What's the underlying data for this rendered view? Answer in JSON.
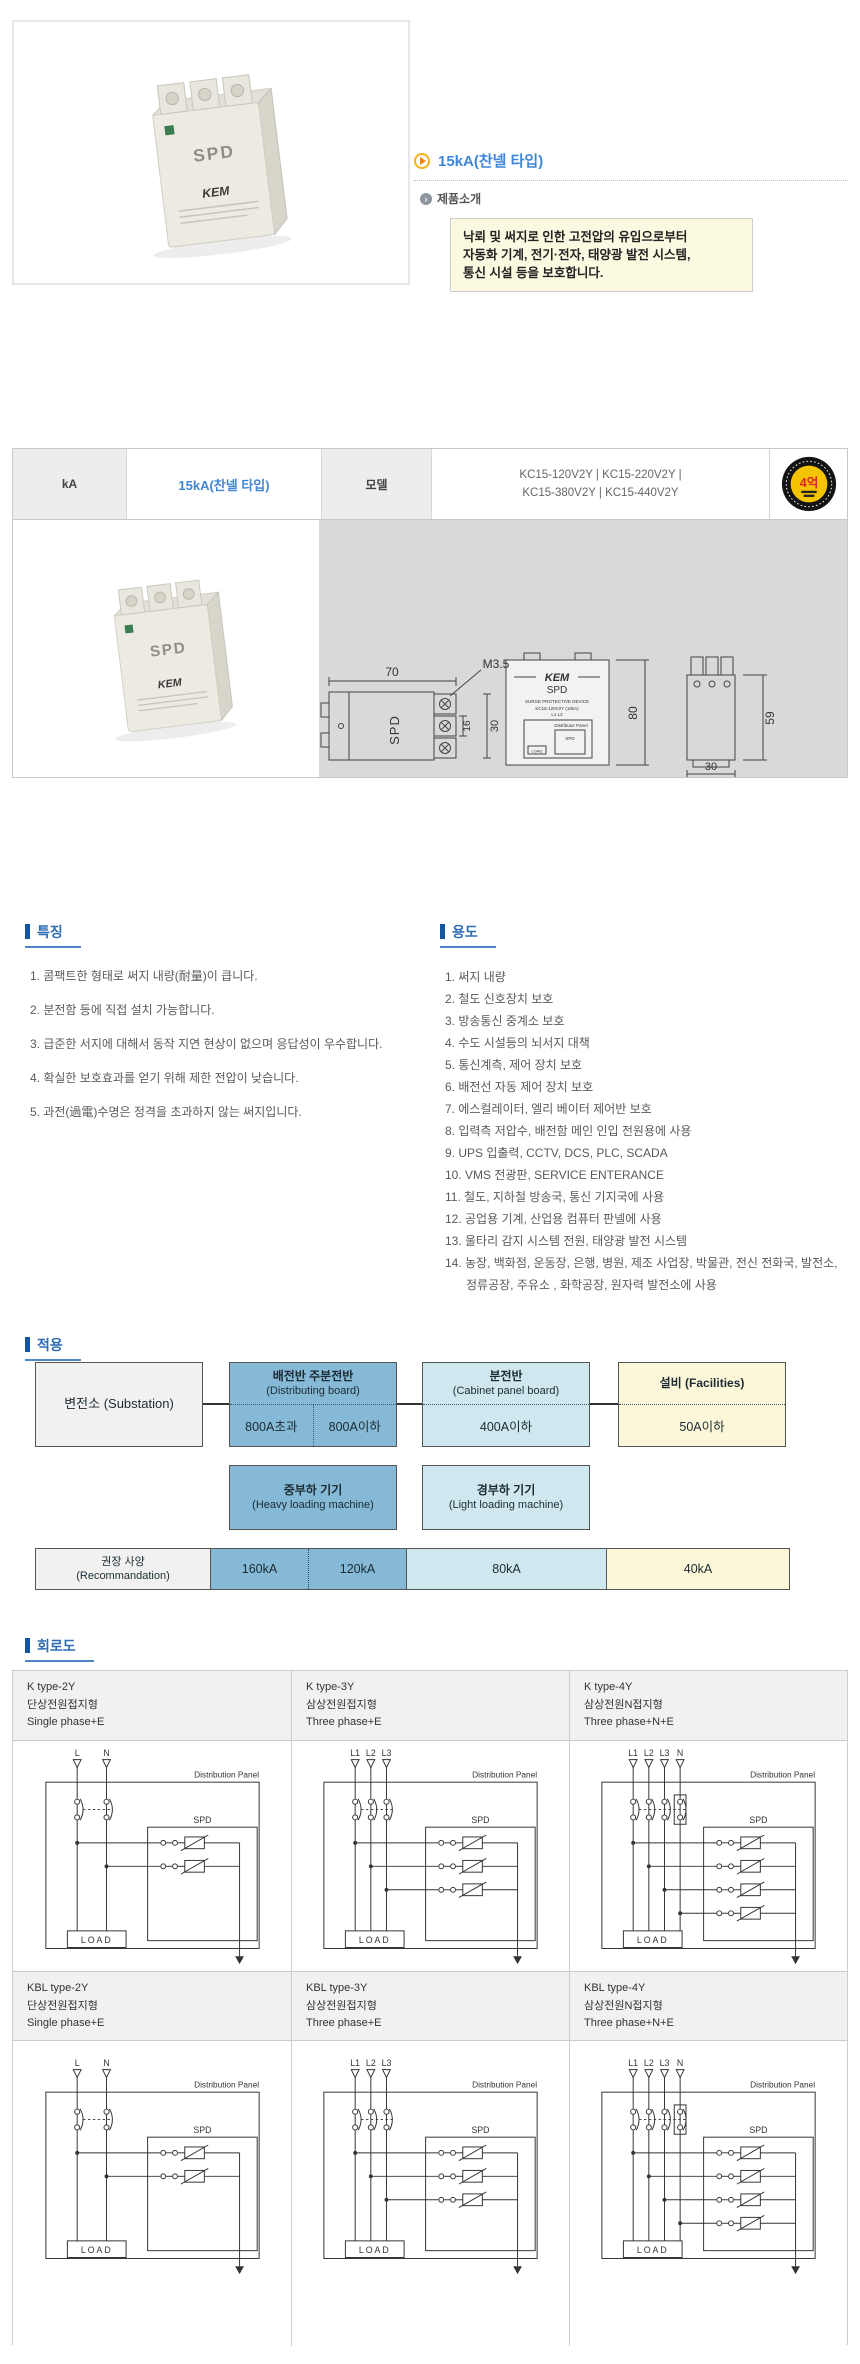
{
  "page": {
    "title": "15kA(찬넬 타입)",
    "intro_label": "제품소개",
    "intro_lines": [
      "낙뢰 및 써지로 인한 고전압의 유입으로부터",
      "자동화 기계, 전기·전자, 태양광 발전 시스템,",
      "통신 시설 등을 보호합니다."
    ]
  },
  "colors": {
    "title_blue": "#3f86d8",
    "section_blue": "#2e6db4",
    "intro_yellow": "#fcf9e1",
    "flow_blue": "#85b9d6",
    "flow_light_blue": "#cfe8ef",
    "flow_yellow": "#fbf7d8",
    "badge_red": "#e02424",
    "badge_yellow": "#f5c400"
  },
  "spec_table": {
    "kA_label": "kA",
    "kA_value": "15kA(찬넬 타입)",
    "model_label": "모델",
    "model_line1": "KC15-120V2Y | KC15-220V2Y |",
    "model_line2": "KC15-380V2Y | KC15-440V2Y",
    "badge_text": "4억"
  },
  "drawing": {
    "dims": {
      "w70": "70",
      "m35": "M3.5",
      "d16": "16",
      "d30": "30",
      "h80": "80",
      "h59": "59",
      "depth30": "30"
    },
    "device": {
      "brand": "KEM",
      "label": "SPD",
      "sub1": "SURGE PROTECTIVE DEVICE",
      "sub2": "KC15-120V2Y (15kA)",
      "sub3": "L1 L2",
      "mini_panel": "Distributor Panel",
      "mini_spd": "SPD",
      "mini_load": "LOAD"
    }
  },
  "features": {
    "title": "특징",
    "items": [
      "1. 콤팩트한 형태로 써지 내량(耐量)이 큽니다.",
      "2. 분전함 등에 직접 설치 가능합니다.",
      "3. 급준한 서지에 대해서 동작 지연 현상이 없으며 응답성이 우수합니다.",
      "4. 확실한 보호효과를 얻기 위해 제한 전압이 낮습니다.",
      "5. 과전(過電)수명은 정격을 초과하지 않는 써지입니다."
    ]
  },
  "uses": {
    "title": "용도",
    "items": [
      "1. 써지 내량",
      "2. 철도 신호장치 보호",
      "3. 방송통신 중계소 보호",
      "4. 수도 시설등의 뇌서지 대책",
      "5. 통신계측, 제어 장치 보호",
      "6. 배전선 자동 제어 장치 보호",
      "7. 에스컬레이터, 엘리 베이터 제어반 보호",
      "8. 입력측 저압수, 배전함 메인 인입 전원용에 사용",
      "9. UPS 입출력, CCTV, DCS, PLC, SCADA",
      "10. VMS 전광판, SERVICE ENTERANCE",
      "11. 철도, 지하철 방송국, 통신 기지국에 사용",
      "12. 공업용 기계, 산업용 컴퓨터 판넬에 사용",
      "13. 울타리 감지 시스템 전원, 태양광 발전 시스템",
      "14. 농장, 백화점, 운동장, 은행, 병원, 제조 사업장, 박물관, 전신 전화국, 발전소, 정류공장, 주유소 , 화학공장, 원자력 발전소에 사용"
    ]
  },
  "application": {
    "title": "적용",
    "substation": "변전소 (Substation)",
    "dist_title": "배전반 주분전반",
    "dist_sub": "(Distributing board)",
    "dist_left": "800A초과",
    "dist_right": "800A이하",
    "cabinet_title": "분전반",
    "cabinet_sub": "(Cabinet panel board)",
    "cabinet_val": "400A이하",
    "fac_title": "설비 (Facilities)",
    "fac_val": "50A이하",
    "heavy_title": "중부하 기기",
    "heavy_sub": "(Heavy loading machine)",
    "light_title": "경부하 기기",
    "light_sub": "(Light loading machine)",
    "reco_line1": "권장 사양",
    "reco_line2": "(Recommandation)",
    "reco_values": [
      "160kA",
      "120kA",
      "80kA",
      "40kA"
    ]
  },
  "circuits": {
    "title": "회로도",
    "labels": {
      "panel": "Distribution Panel",
      "spd": "SPD",
      "load": "LOAD"
    },
    "cells": [
      {
        "type": "K type-2Y",
        "kr": "단상전원접지형",
        "en": "Single phase+E",
        "lines": [
          "L",
          "N"
        ]
      },
      {
        "type": "K type-3Y",
        "kr": "삼상전원접지형",
        "en": "Three phase+E",
        "lines": [
          "L1",
          "L2",
          "L3"
        ]
      },
      {
        "type": "K type-4Y",
        "kr": "삼상전원N접지형",
        "en": "Three phase+N+E",
        "lines": [
          "L1",
          "L2",
          "L3",
          "N"
        ],
        "nbox": true
      },
      {
        "type": "KBL type-2Y",
        "kr": "단상전원접지형",
        "en": "Single phase+E",
        "lines": [
          "L",
          "N"
        ]
      },
      {
        "type": "KBL type-3Y",
        "kr": "삼상전원접지형",
        "en": "Three phase+E",
        "lines": [
          "L1",
          "L2",
          "L3"
        ]
      },
      {
        "type": "KBL type-4Y",
        "kr": "삼상전원N접지형",
        "en": "Three phase+N+E",
        "lines": [
          "L1",
          "L2",
          "L3",
          "N"
        ],
        "nbox": true
      }
    ]
  }
}
